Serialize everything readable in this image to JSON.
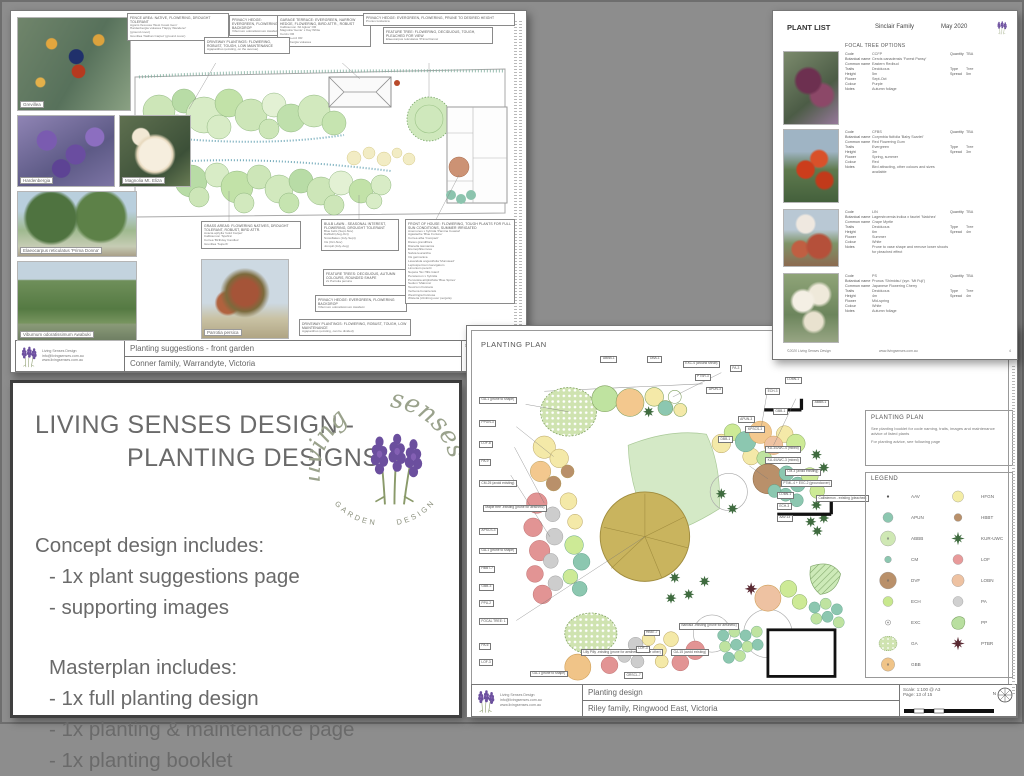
{
  "doc_front_garden": {
    "title": "Planting suggestions - front garden",
    "client": "Conner family, Warrandyte, Victoria",
    "scale": "Scale: NA @ A3",
    "contact": [
      "Living Senses Design",
      "info@livingsenses.com.au",
      "www.livingsenses.com.au"
    ],
    "photos": [
      {
        "kind": "grevillea",
        "caption": "Grevillea",
        "x": 6,
        "y": 6,
        "w": 114,
        "h": 94
      },
      {
        "kind": "hardenbergia",
        "caption": "Hardenbergia",
        "x": 6,
        "y": 104,
        "w": 98,
        "h": 72
      },
      {
        "kind": "magnolia",
        "caption": "Magnolia Mt. Eliza",
        "x": 108,
        "y": 104,
        "w": 72,
        "h": 72
      },
      {
        "kind": "trees",
        "caption": "Elaeocarpus reticulatus 'Prima Donna'",
        "x": 6,
        "y": 180,
        "w": 120,
        "h": 66
      },
      {
        "kind": "viburnum",
        "caption": "Viburnum odoratissimum Awabuki",
        "x": 6,
        "y": 250,
        "w": 120,
        "h": 80
      },
      {
        "kind": "parrotia",
        "caption": "Parrotia persica",
        "x": 190,
        "y": 248,
        "w": 88,
        "h": 80
      }
    ],
    "callouts": [
      {
        "x": 116,
        "y": 2,
        "w": 96,
        "header": "FENCE AREA: NATIVE, FLOWERING, DROUGHT TOLERANT",
        "lines": [
          "Agonis flexuosa 'West Coast Gem'",
          "Hardenbergia violacea 'Happy Wanderer'",
          "(ground cover)",
          "Grevillea 'Nathan Carpet' (ground cover)"
        ]
      },
      {
        "x": 218,
        "y": 4,
        "w": 54,
        "header": "PRIVACY HEDGE: EVERGREEN, FLOWERING BACKDROP",
        "lines": [
          "Viburnum odoratissimum Awabuki"
        ]
      },
      {
        "x": 266,
        "y": 4,
        "w": 88,
        "header": "GARAGE TERRACE: EVERGREEN, NARROW HEDGE, FLOWERING, BIRD ATTR., ROBUST",
        "lines": [
          "Callistemon 'All Aglow' OR",
          "Magnolia 'Genie' x Kay White",
          "Cercis OR",
          "Hebe co-ord OR",
          "Hardenbergia violacea"
        ]
      },
      {
        "x": 352,
        "y": 2,
        "w": 146,
        "header": "PRIVACY HEDGE: EVERGREEN, FLOWERING, PRUNE TO DESIRED HEIGHT",
        "lines": [
          "Prunus lusitanica"
        ]
      },
      {
        "x": 193,
        "y": 26,
        "w": 80,
        "header": "DRIVEWAY PLANTINGS: FLOWERING, ROBUST, TOUGH, LOW MAINTENANCE",
        "lines": [
          "Agapanthus (existing, on the avenue)"
        ]
      },
      {
        "x": 372,
        "y": 16,
        "w": 104,
        "header": "FEATURE TREE: FLOWERING, DECIDUOUS, TOUGH, PLEACHED FOR VIEW",
        "lines": [
          "Elaeocarpus reticulatus 'Prima Donna'"
        ]
      },
      {
        "x": 190,
        "y": 210,
        "w": 94,
        "header": "GRASS AREAS: FLOWERING NATIVES, DROUGHT TOLERANT, ROBUST, BIRD ATTR.",
        "lines": [
          "Acacia aphylla 'Gold Carpet'",
          "Callistemon 'Spofira'",
          "Correa 'Birthday Candles'",
          "Grevillea 'Superb'"
        ]
      },
      {
        "x": 310,
        "y": 208,
        "w": 72,
        "header": "BULB LAWN - SEASONAL INTEREST, FLOWERING, DROUGHT TOLERANT",
        "lines": [
          "Blue bells (Sept-Nov)",
          "Daffodil (Aug-Oct)",
          "Snowflakes (July-Sept)",
          "Iris (Oct-Nov)",
          "Jonquil (July-Aug)"
        ]
      },
      {
        "x": 312,
        "y": 258,
        "w": 84,
        "header": "FEATURE TREES: DECIDUOUS, AUTUMN COLOURS, ROUNDED SHAPE",
        "lines": [
          "2x Parrotia persica"
        ]
      },
      {
        "x": 304,
        "y": 284,
        "w": 86,
        "header": "PRIVACY HEDGE: EVERGREEN, FLOWERING BACKDROP",
        "lines": [
          "Viburnum odoratissimum Awabuki"
        ]
      },
      {
        "x": 288,
        "y": 308,
        "w": 106,
        "header": "DRIVEWAY PLANTINGS: FLOWERING, ROBUST, TOUGH, LOW MAINTENANCE",
        "lines": [
          "Agapanthus (existing, can be divided)"
        ]
      },
      {
        "x": 394,
        "y": 208,
        "w": 104,
        "header": "FRONT OF HOUSE: FLOWERING, TOUGH PLANTS FOR FULL SUN CONDITIONS, SUMMER IRRIGATED",
        "lines": [
          "Anemones x hybrida 'Pamina Coastal'",
          "Agastache 'Blue Fortune'",
          "Correa alba 'Compact'",
          "Dietes grandiflora",
          "Dianella tasmanica",
          "Eremophila nivea",
          "Salvia leucantha",
          "Iris germanica",
          "Lavandula angustifolia 'Munstead'",
          "Leptospermum laevigatum",
          "Limonium perezii",
          "Nepeta 'Six Hills Giant'",
          "Penstemon x hybrida",
          "Perovskia atriplicifolia 'Blue Spires'",
          "Sedum 'Matrona'",
          "Teucrium fruticans",
          "Verbena bonariensis",
          "Westringia fruticosa",
          "Wisteria (climbing over pergola)"
        ]
      }
    ]
  },
  "doc_plant_list": {
    "header": {
      "title": "PLANT LIST",
      "family": "Sinclair Family",
      "date": "May 2020"
    },
    "section": "FOCAL TREE OPTIONS",
    "field_labels": {
      "code": "Code",
      "botanical": "Botanical name",
      "common": "Common name",
      "traits": "Traits",
      "type": "Type",
      "height": "Height",
      "spread": "Spread",
      "flower": "Flower",
      "colour": "Colour",
      "notes": "Notes",
      "quantity": "Quantity"
    },
    "entries": [
      {
        "kind": "ccfp",
        "y": 40,
        "ph": 74,
        "code": "CCFP",
        "botanical": "Cercis canadensis 'Forest Pansy'",
        "common": "Eastern Redbud",
        "traits": "Deciduous",
        "type": "Tree",
        "height": "5m",
        "spread": "5m",
        "flower": "Sept-Oct",
        "colour": "Purple",
        "notes": "Autumn foliage",
        "quantity": "TBA"
      },
      {
        "kind": "cfbs",
        "y": 118,
        "ph": 74,
        "code": "CFBS",
        "botanical": "Corymbia ficifolia 'Baby Scarlet'",
        "common": "Red Flowering Gum",
        "traits": "Evergreen",
        "type": "Tree",
        "height": "3m",
        "spread": "3m",
        "flower": "Spring, summer",
        "colour": "Red",
        "notes": "Bird attracting, other colours and sizes available",
        "quantity": "TBA"
      },
      {
        "kind": "lin",
        "y": 198,
        "ph": 58,
        "code": "LIN",
        "botanical": "Lagerstroemia indica x fauriei 'Natchez'",
        "common": "Crape Myrtle",
        "traits": "Deciduous",
        "type": "Tree",
        "height": "6m",
        "spread": "4m",
        "flower": "Summer",
        "colour": "White",
        "notes": "Prune to vase shape and remove lower shoots for pleached effect",
        "quantity": "TBA"
      },
      {
        "kind": "ps",
        "y": 262,
        "ph": 70,
        "code": "PS",
        "botanical": "Prunus 'Shimidsu' (syn. 'Mt Fuji')",
        "common": "Japanese Flowering Cherry",
        "traits": "Deciduous",
        "type": "Tree",
        "height": "4m",
        "spread": "4m",
        "flower": "Mid-spring",
        "colour": "White",
        "notes": "Autumn foliage",
        "quantity": "TBA"
      }
    ],
    "footer": {
      "copyright": "©2020 Living Senses Design",
      "url": "www.livingsenses.com.au",
      "page": "4"
    }
  },
  "panel_promo": {
    "title_line1": "LIVING SENSES DESIGN -",
    "title_line2": "PLANTING DESIGNS",
    "concept_heading": "Concept design includes:",
    "concept_items": [
      "-  1x plant suggestions page",
      "- supporting images"
    ],
    "master_heading": "Masterplan includes:",
    "master_items": [
      "-  1x full planting design",
      "-  1x planting & maintenance page",
      "-  1x planting booklet"
    ],
    "logo": {
      "script1": "living",
      "script2": "senses",
      "arc1": "GARDEN",
      "arc2": "DESIGN"
    }
  },
  "doc_planting_plan": {
    "plan_title": "PLANTING PLAN",
    "note_box": {
      "title": "PLANTING PLAN",
      "line1": "See planting booklet for code naming, traits, images and maintenance advice of listed plants",
      "line2": "For planting advice, see following page"
    },
    "legend": {
      "title": "LEGEND",
      "items_left": [
        {
          "code": "AAV",
          "sym": "dot",
          "color": "#555555",
          "size": 4
        },
        {
          "code": "APUN",
          "sym": "circle",
          "color": "#8cc7b0",
          "size": 18
        },
        {
          "code": "ABBB",
          "sym": "circle-dot",
          "color": "#cfe8b4",
          "size": 27
        },
        {
          "code": "CM",
          "sym": "circle",
          "color": "#8cc7b0",
          "size": 12
        },
        {
          "code": "DVF",
          "sym": "circle-dot",
          "color": "#b9906a",
          "size": 30
        },
        {
          "code": "ECH",
          "sym": "circle",
          "color": "#c8e88e",
          "size": 18
        },
        {
          "code": "EXC",
          "sym": "ring",
          "color": "#888888",
          "size": 9
        },
        {
          "code": "GA",
          "sym": "polka",
          "color": "#cfe3b0",
          "size": 34
        },
        {
          "code": "GBB",
          "sym": "circle-dot",
          "color": "#f0c488",
          "size": 24
        }
      ],
      "items_right": [
        {
          "code": "HFGN",
          "sym": "circle",
          "color": "#f4eda6",
          "size": 20
        },
        {
          "code": "HBBT",
          "sym": "circle",
          "color": "#b9906a",
          "size": 14
        },
        {
          "code": "KUR-UWC",
          "sym": "flower",
          "color": "#3f6b3f",
          "size": 16
        },
        {
          "code": "LOF",
          "sym": "circle",
          "color": "#e89a9a",
          "size": 18
        },
        {
          "code": "LOBN",
          "sym": "circle",
          "color": "#eec2a2",
          "size": 22
        },
        {
          "code": "PA",
          "sym": "circle",
          "color": "#d0d0d0",
          "size": 18
        },
        {
          "code": "PP",
          "sym": "blob",
          "color": "#b9dfa0",
          "size": 26
        },
        {
          "code": "PTBR",
          "sym": "star",
          "color": "#5a2a33",
          "size": 13
        }
      ]
    },
    "titleblock": {
      "doc_title": "Planting design",
      "client": "Riley family, Ringwood East, Victoria",
      "scale": "Scale: 1:100 @ A3",
      "page": "Page: 13 of 15",
      "north": "N"
    },
    "contact": [
      "Living Senses Design",
      "info@livingsenses.com.au",
      "www.livingsenses.com.au"
    ],
    "plan_callouts": [
      {
        "t": "ABBB-1",
        "x": 32,
        "y": 0.5
      },
      {
        "t": "DBA-1",
        "x": 44,
        "y": 0.5
      },
      {
        "t": "EXC-4 (around shrub)",
        "x": 53,
        "y": 2
      },
      {
        "t": "PTSR-3",
        "x": 56,
        "y": 6
      },
      {
        "t": "APUN-3",
        "x": 59,
        "y": 10
      },
      {
        "t": "GA-1 (prune to shape)",
        "x": 1,
        "y": 13
      },
      {
        "t": "PPGN-3",
        "x": 1,
        "y": 20
      },
      {
        "t": "LOF-8",
        "x": 1,
        "y": 26.5
      },
      {
        "t": "PA-9",
        "x": 1,
        "y": 32
      },
      {
        "t": "CM-25 (avoid existing)",
        "x": 1,
        "y": 38.5
      },
      {
        "t": "Maple tree -existing (prune for aesthetic)",
        "x": 2,
        "y": 46
      },
      {
        "t": "APSCS-3",
        "x": 1,
        "y": 53
      },
      {
        "t": "GA-1 (prune to shape)",
        "x": 1,
        "y": 59
      },
      {
        "t": "HBBT-7",
        "x": 1,
        "y": 64.5
      },
      {
        "t": "GBB-3",
        "x": 1,
        "y": 70
      },
      {
        "t": "PPU-2",
        "x": 1,
        "y": 75
      },
      {
        "t": "FOCAL TREE: 1",
        "x": 1,
        "y": 80.5
      },
      {
        "t": "PA-6",
        "x": 1,
        "y": 88
      },
      {
        "t": "LOF-3",
        "x": 1,
        "y": 93
      },
      {
        "t": "GA-1 (prune to shape)",
        "x": 14,
        "y": 96.5
      },
      {
        "t": "Lilly Pilly -existing (prune for aesthetic, remove other)",
        "x": 27,
        "y": 90
      },
      {
        "t": "GRSCL-7",
        "x": 38,
        "y": 97
      },
      {
        "t": "LOF-3",
        "x": 41,
        "y": 89
      },
      {
        "t": "HBBT-7",
        "x": 43,
        "y": 84
      },
      {
        "t": "GA-15 (avoid existing)",
        "x": 50,
        "y": 90
      },
      {
        "t": "Banksia -existing (prune for aesthetic)",
        "x": 52,
        "y": 82
      },
      {
        "t": "PA-3",
        "x": 65,
        "y": 3.5
      },
      {
        "t": "LOBN-1",
        "x": 79,
        "y": 7
      },
      {
        "t": "ECH-3",
        "x": 74,
        "y": 10.5
      },
      {
        "t": "ABBB-1",
        "x": 86,
        "y": 14
      },
      {
        "t": "GBB-1",
        "x": 76,
        "y": 16.5
      },
      {
        "t": "APUN-3",
        "x": 67,
        "y": 19
      },
      {
        "t": "KPSCS-3",
        "x": 69,
        "y": 22
      },
      {
        "t": "DBB-1",
        "x": 62,
        "y": 25
      },
      {
        "t": "KU-3/UWC-4 (mixed)",
        "x": 74,
        "y": 28
      },
      {
        "t": "KU-4/UWC-3 (mixed)",
        "x": 74,
        "y": 31.5
      },
      {
        "t": "CM-3 (avoid existing)",
        "x": 79,
        "y": 35
      },
      {
        "t": "PTML-4 + EXC-2 (groundcover)",
        "x": 78,
        "y": 38.5
      },
      {
        "t": "LOBN-1",
        "x": 77,
        "y": 42
      },
      {
        "t": "ECH-3",
        "x": 77,
        "y": 45.5
      },
      {
        "t": "AAV-13",
        "x": 77,
        "y": 49
      },
      {
        "t": "Callistemon - existing (pleached)",
        "x": 87,
        "y": 43
      }
    ]
  }
}
